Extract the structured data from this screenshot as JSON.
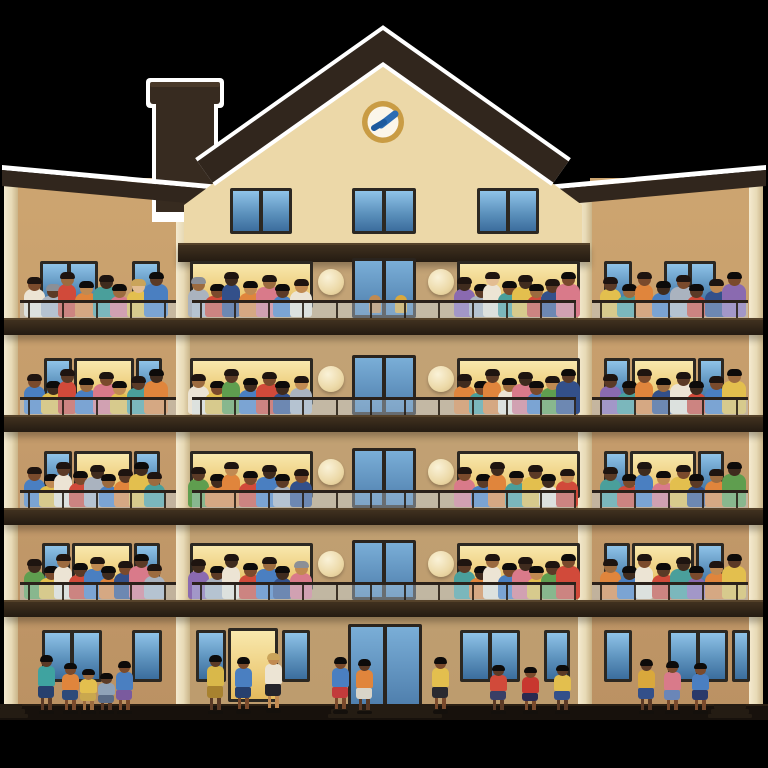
{
  "scene": {
    "background": "#000000",
    "street_color": "#000000",
    "sidewalk_color": "#17110c",
    "sidewalk_edge": "#2b2014",
    "halo_color": "#ffffff",
    "description": "Illustration of a five-storey apartment building at dusk, every balcony crowded with residents, more people standing on the sidewalk below"
  },
  "building": {
    "left": 4,
    "right": 763,
    "wall_top": 178,
    "wall_bottom": 708,
    "wing_wall_color": "#c7a06e",
    "center_wall_color": "#c0a173",
    "pilaster_color": "#ece0c3",
    "pilaster_xs": [
      4,
      176,
      578,
      749
    ],
    "pilaster_w": 14,
    "center_left": 178,
    "center_right": 590,
    "slab_ys": [
      318,
      415,
      508,
      600
    ],
    "slab_h": 15,
    "top_slab": {
      "x": 178,
      "w": 412,
      "y": 243,
      "h": 17
    }
  },
  "roof": {
    "band_color": "#31261d",
    "apex": [
      383,
      46
    ],
    "eave_left": [
      205,
      172
    ],
    "eave_right": [
      561,
      172
    ],
    "band_width": 26,
    "gable_wall_color": "#ecd8a8",
    "gable_wall_poly": "383,58 582,205 582,243 184,243 184,205",
    "cornice_left_poly": "2,170 242,192 242,208 2,186",
    "cornice_right_poly": "524,192 766,170 766,186 524,208",
    "cornice_left_halo": "2,165 242,187 242,192 2,170",
    "cornice_right_halo": "524,187 766,165 766,170 524,192",
    "chimney": {
      "cap_x": 150,
      "cap_y": 82,
      "cap_w": 70,
      "cap_h": 22,
      "body_x": 156,
      "body_y": 100,
      "body_w": 58,
      "body_h": 112,
      "color": "#372b20"
    }
  },
  "clock": {
    "cx": 383,
    "cy": 122,
    "r": 21,
    "ring_color": "#c99c44",
    "face_color": "#fbf6ea",
    "hand_color": "#2b6cb3"
  },
  "attic": {
    "win_y": 188,
    "win_h": 46,
    "windows": [
      {
        "x": 230,
        "w": 62
      },
      {
        "x": 352,
        "w": 64
      },
      {
        "x": 477,
        "w": 62
      }
    ]
  },
  "window_metrics": {
    "top_offset": 57,
    "h": 47,
    "door_top_offset": 60,
    "door_h": 60,
    "door_x": 352,
    "door_w": 64
  },
  "sconce": {
    "r": 13,
    "cy_offset": 36
  },
  "railing": {
    "glass_h": 15,
    "post_gap": 34,
    "segments": [
      [
        20,
        176
      ],
      [
        192,
        576
      ],
      [
        592,
        748
      ]
    ]
  },
  "palettes": {
    "skin": [
      "#3f2b1e",
      "#5b3a26",
      "#7a4a2c",
      "#9c6b3f",
      "#c08a52",
      "#e3bd92"
    ],
    "shirt": [
      "#d14a3a",
      "#e0853c",
      "#e3bf4e",
      "#5f9e4f",
      "#4a9f9b",
      "#4a7fc1",
      "#33508a",
      "#8a6ab0",
      "#d97a8a",
      "#aab3bf",
      "#ece4d4"
    ],
    "hair": [
      "#1e1410",
      "#0d0b0a",
      "#3a2418",
      "#8b8f96",
      "#caa45a"
    ]
  },
  "group_ranges": {
    "lw": [
      24,
      168
    ],
    "cl": [
      188,
      314
    ],
    "cr": [
      454,
      580
    ],
    "rw": [
      600,
      746
    ]
  },
  "floors": [
    {
      "slab": 318,
      "sconces": [
        331,
        441
      ],
      "windows": [
        {
          "x": 40,
          "w": 58,
          "lit": false,
          "mull": true
        },
        {
          "x": 132,
          "w": 28,
          "lit": false
        },
        {
          "x": 190,
          "w": 123,
          "lit": true
        },
        {
          "x": 457,
          "w": 123,
          "lit": true
        },
        {
          "x": 604,
          "w": 28,
          "lit": false
        },
        {
          "x": 664,
          "w": 52,
          "lit": false,
          "mull": true
        }
      ],
      "door_people": [
        "#c08a52",
        "#d9a83c"
      ],
      "props": [
        {
          "type": "table",
          "x": 34,
          "w": 42,
          "h": 20
        }
      ],
      "groups": {
        "lw": [
          [
            2,
            10
          ],
          [
            1,
            9,
            3
          ],
          [
            3,
            0
          ],
          [
            4,
            1
          ],
          [
            0,
            4
          ],
          [
            3,
            8
          ],
          [
            5,
            2,
            4
          ],
          [
            1,
            5
          ]
        ],
        "cl": [
          [
            3,
            9,
            3
          ],
          [
            2,
            0
          ],
          [
            0,
            6
          ],
          [
            4,
            1
          ],
          [
            3,
            8
          ],
          [
            1,
            5
          ],
          [
            4,
            10
          ]
        ],
        "cr": [
          [
            0,
            7
          ],
          [
            1,
            9
          ],
          [
            5,
            10
          ],
          [
            2,
            4
          ],
          [
            0,
            2
          ],
          [
            3,
            0
          ],
          [
            1,
            6
          ],
          [
            2,
            8
          ]
        ],
        "rw": [
          [
            1,
            2
          ],
          [
            3,
            4
          ],
          [
            2,
            1
          ],
          [
            0,
            5
          ],
          [
            2,
            9
          ],
          [
            1,
            0
          ],
          [
            4,
            6
          ],
          [
            2,
            7
          ]
        ]
      }
    },
    {
      "slab": 415,
      "sconces": [
        331,
        441
      ],
      "windows": [
        {
          "x": 44,
          "w": 28,
          "lit": false
        },
        {
          "x": 74,
          "w": 60,
          "lit": true
        },
        {
          "x": 136,
          "w": 26,
          "lit": false
        },
        {
          "x": 190,
          "w": 123,
          "lit": true
        },
        {
          "x": 457,
          "w": 123,
          "lit": true
        },
        {
          "x": 604,
          "w": 26,
          "lit": false
        },
        {
          "x": 632,
          "w": 64,
          "lit": true
        },
        {
          "x": 698,
          "w": 26,
          "lit": false
        }
      ],
      "groups": {
        "lw": [
          [
            2,
            5
          ],
          [
            0,
            2
          ],
          [
            1,
            0
          ],
          [
            3,
            5
          ],
          [
            2,
            8
          ],
          [
            4,
            2
          ],
          [
            1,
            4
          ],
          [
            0,
            1
          ]
        ],
        "cl": [
          [
            3,
            10
          ],
          [
            2,
            2
          ],
          [
            1,
            3
          ],
          [
            0,
            5
          ],
          [
            2,
            0
          ],
          [
            0,
            6
          ],
          [
            4,
            9
          ]
        ],
        "cr": [
          [
            0,
            1
          ],
          [
            2,
            4
          ],
          [
            1,
            1
          ],
          [
            3,
            10
          ],
          [
            0,
            8
          ],
          [
            2,
            5
          ],
          [
            4,
            3
          ],
          [
            1,
            6
          ]
        ],
        "rw": [
          [
            1,
            7
          ],
          [
            0,
            4
          ],
          [
            2,
            1
          ],
          [
            3,
            6
          ],
          [
            1,
            10
          ],
          [
            0,
            0
          ],
          [
            2,
            5
          ],
          [
            3,
            2
          ]
        ]
      }
    },
    {
      "slab": 508,
      "sconces": [
        331,
        441
      ],
      "windows": [
        {
          "x": 44,
          "w": 28,
          "lit": false
        },
        {
          "x": 74,
          "w": 58,
          "lit": true
        },
        {
          "x": 134,
          "w": 26,
          "lit": false
        },
        {
          "x": 190,
          "w": 123,
          "lit": true
        },
        {
          "x": 457,
          "w": 123,
          "lit": true
        },
        {
          "x": 604,
          "w": 24,
          "lit": false
        },
        {
          "x": 630,
          "w": 66,
          "lit": true
        },
        {
          "x": 698,
          "w": 26,
          "lit": false
        }
      ],
      "groups": {
        "lw": [
          [
            2,
            5
          ],
          [
            4,
            2
          ],
          [
            1,
            10
          ],
          [
            2,
            0
          ],
          [
            0,
            9
          ],
          [
            3,
            5
          ],
          [
            1,
            1
          ],
          [
            0,
            2
          ],
          [
            3,
            4
          ]
        ],
        "cl": [
          [
            1,
            3
          ],
          [
            0,
            1
          ],
          [
            4,
            1
          ],
          [
            2,
            0
          ],
          [
            0,
            5
          ],
          [
            1,
            9
          ],
          [
            2,
            6
          ]
        ],
        "cr": [
          [
            2,
            8
          ],
          [
            1,
            5
          ],
          [
            0,
            1
          ],
          [
            3,
            4
          ],
          [
            1,
            2
          ],
          [
            0,
            10
          ],
          [
            4,
            0
          ]
        ],
        "rw": [
          [
            1,
            4
          ],
          [
            2,
            0
          ],
          [
            0,
            5
          ],
          [
            4,
            8
          ],
          [
            2,
            2
          ],
          [
            1,
            6
          ],
          [
            3,
            1
          ],
          [
            0,
            3
          ]
        ]
      }
    },
    {
      "slab": 600,
      "sconces": [
        331,
        441
      ],
      "windows": [
        {
          "x": 42,
          "w": 28,
          "lit": false
        },
        {
          "x": 72,
          "w": 60,
          "lit": true
        },
        {
          "x": 134,
          "w": 26,
          "lit": false
        },
        {
          "x": 190,
          "w": 123,
          "lit": true
        },
        {
          "x": 457,
          "w": 123,
          "lit": true
        },
        {
          "x": 604,
          "w": 26,
          "lit": false
        },
        {
          "x": 632,
          "w": 62,
          "lit": true
        },
        {
          "x": 696,
          "w": 28,
          "lit": false
        }
      ],
      "groups": {
        "lw": [
          [
            0,
            3
          ],
          [
            2,
            2
          ],
          [
            3,
            10
          ],
          [
            1,
            0
          ],
          [
            4,
            5
          ],
          [
            0,
            1
          ],
          [
            2,
            6
          ],
          [
            1,
            8
          ],
          [
            3,
            9
          ]
        ],
        "cl": [
          [
            0,
            7
          ],
          [
            1,
            9
          ],
          [
            0,
            10
          ],
          [
            2,
            0
          ],
          [
            3,
            5
          ],
          [
            0,
            6
          ],
          [
            4,
            8,
            3
          ]
        ],
        "cr": [
          [
            1,
            4
          ],
          [
            0,
            1
          ],
          [
            3,
            10
          ],
          [
            2,
            5
          ],
          [
            0,
            8
          ],
          [
            4,
            2
          ],
          [
            1,
            3
          ],
          [
            2,
            0
          ]
        ],
        "rw": [
          [
            3,
            1
          ],
          [
            0,
            5
          ],
          [
            2,
            10
          ],
          [
            1,
            0
          ],
          [
            0,
            4
          ],
          [
            2,
            7
          ],
          [
            4,
            1
          ],
          [
            1,
            2
          ]
        ]
      }
    }
  ],
  "ground": {
    "win_y": 630,
    "win_h": 52,
    "windows": [
      {
        "x": 42,
        "w": 60,
        "lit": false,
        "mull": true
      },
      {
        "x": 132,
        "w": 30,
        "lit": false
      },
      {
        "x": 196,
        "w": 30,
        "lit": false
      },
      {
        "x": 282,
        "w": 28,
        "lit": false
      },
      {
        "x": 460,
        "w": 60,
        "lit": false,
        "mull": true
      },
      {
        "x": 544,
        "w": 26,
        "lit": false
      },
      {
        "x": 604,
        "w": 28,
        "lit": false
      },
      {
        "x": 668,
        "w": 60,
        "lit": false,
        "mull": true
      },
      {
        "x": 732,
        "w": 18,
        "lit": false
      }
    ],
    "lit_entry": {
      "x": 228,
      "w": 50,
      "y": 628,
      "h": 74
    },
    "entrance_door": {
      "x": 348,
      "w": 74,
      "y": 624,
      "h": 84
    },
    "steps_main": {
      "x": 334,
      "w": 102
    },
    "steps_right": {
      "x": 714,
      "w": 32
    },
    "steps_left": {
      "x": 0,
      "w": 22
    },
    "people": [
      {
        "x": 36,
        "skin": 1,
        "shirt": "#3fa3a0",
        "bottom": "#27406e",
        "h": 58
      },
      {
        "x": 60,
        "skin": 2,
        "shirt": "#e0853c",
        "bottom": "#2d4a7a",
        "h": 50
      },
      {
        "x": 78,
        "skin": 3,
        "shirt": "#e3bf4e",
        "bottom": "#caa84e",
        "h": 44
      },
      {
        "x": 96,
        "skin": 1,
        "shirt": "#8fa2b8",
        "bottom": "#5a6b86",
        "h": 40
      },
      {
        "x": 114,
        "skin": 2,
        "shirt": "#4a7fc1",
        "bottom": "#7a5a9e",
        "h": 52
      },
      {
        "x": 205,
        "skin": 1,
        "shirt": "#d9b84a",
        "bottom": "#a8822f",
        "h": 58
      },
      {
        "x": 233,
        "skin": 2,
        "shirt": "#4a7fc1",
        "bottom": "#27406e",
        "h": 56
      },
      {
        "x": 263,
        "skin": 4,
        "shirt": "#ece4d4",
        "bottom": "#24242a",
        "h": 60,
        "hair": 4
      },
      {
        "x": 330,
        "skin": 2,
        "shirt": "#4a7fc1",
        "bottom": "#c23b3b",
        "h": 56
      },
      {
        "x": 354,
        "skin": 1,
        "shirt": "#e0853c",
        "bottom": "#d8d4c8",
        "h": 54
      },
      {
        "x": 430,
        "skin": 2,
        "shirt": "#e3bf4e",
        "bottom": "#2a2a30",
        "h": 56
      },
      {
        "x": 488,
        "skin": 1,
        "shirt": "#d14a3a",
        "bottom": "#3a3f66",
        "h": 48
      },
      {
        "x": 520,
        "skin": 2,
        "shirt": "#c8372f",
        "bottom": "#2a2a50",
        "h": 46
      },
      {
        "x": 552,
        "skin": 1,
        "shirt": "#e3bf4e",
        "bottom": "#33508a",
        "h": 48
      },
      {
        "x": 636,
        "skin": 1,
        "shirt": "#d9a83c",
        "bottom": "#33508a",
        "h": 54
      },
      {
        "x": 662,
        "skin": 2,
        "shirt": "#d97a8a",
        "bottom": "#6a86b8",
        "h": 52
      },
      {
        "x": 690,
        "skin": 2,
        "shirt": "#4a7fc1",
        "bottom": "#2a3a6a",
        "h": 50
      }
    ]
  },
  "ground_metrics": {
    "sidewalk_y": 704,
    "sidewalk_h": 16,
    "street_y": 720,
    "feet_y": 714
  }
}
